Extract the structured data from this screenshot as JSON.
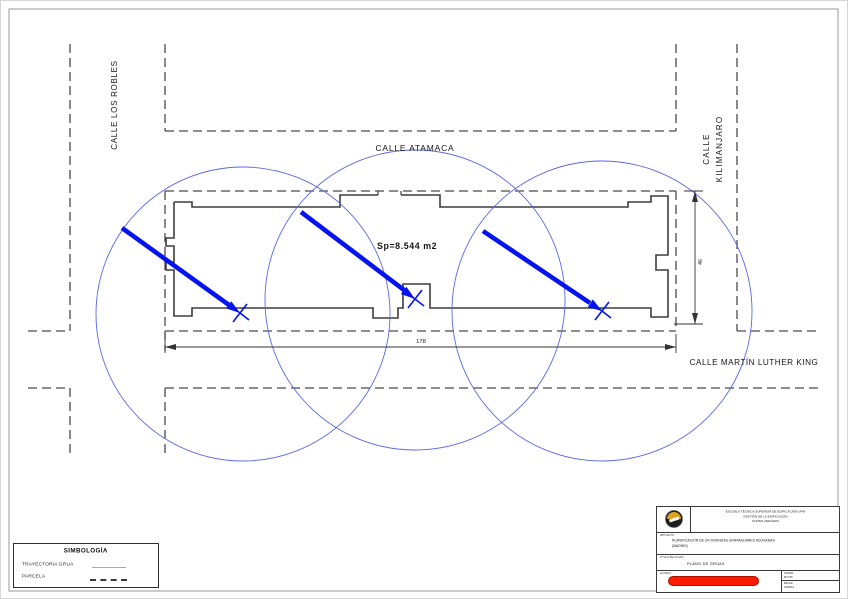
{
  "sheet": {
    "streets": {
      "atamaca": "CALLE ATAMACA",
      "los_robles": "CALLE LOS ROBLES",
      "kilimanjaro_line1": "CALLE",
      "kilimanjaro_line2": "KILIMANJARO",
      "martin_luther_king": "CALLE MARTÍN LUTHER KING"
    },
    "annotations": {
      "area_label": "Sp=8.544 m2",
      "dim_width": "178",
      "dim_height": "46"
    },
    "colors": {
      "trajectory_blue": "#0513ee",
      "crane_circle_blue": "#5c67ea",
      "parcel_dash_gray": "#4a4a4a",
      "building_gray": "#3d3d3d",
      "redaction_red": "#fb1c00"
    }
  },
  "legend": {
    "title": "SIMBOLOGÍA",
    "items": [
      {
        "label": "TRAYECTORIA GRUA",
        "symbol": "crane-trajectory-line"
      },
      {
        "label": "PARCELA",
        "symbol": "parcel-dashed-line"
      }
    ]
  },
  "title_block": {
    "school_line1": "ESCUELA TÉCNICA SUPERIOR DE EDIFICACIÓN  UPM",
    "school_line2": "GESTIÓN DE LA EDIFICACIÓN",
    "school_line3": "CURSO 2022/2023",
    "project_label": "PROYECTO:",
    "project_line1": "PLANIFICACIÓN DE 34 VIVIENDAS UNIFAMILIARES ADOSADAS",
    "project_line2": "(MADRID)",
    "plan_label": "TÍTULO DEL PLANO:",
    "plan_title": "PLANO DE GRÚAS",
    "student_label": "ALUMNO:",
    "group_label": "GRUPO:",
    "group_value": "M3 T06",
    "date_label": "FECHA:",
    "date_value": "14/03/14"
  }
}
